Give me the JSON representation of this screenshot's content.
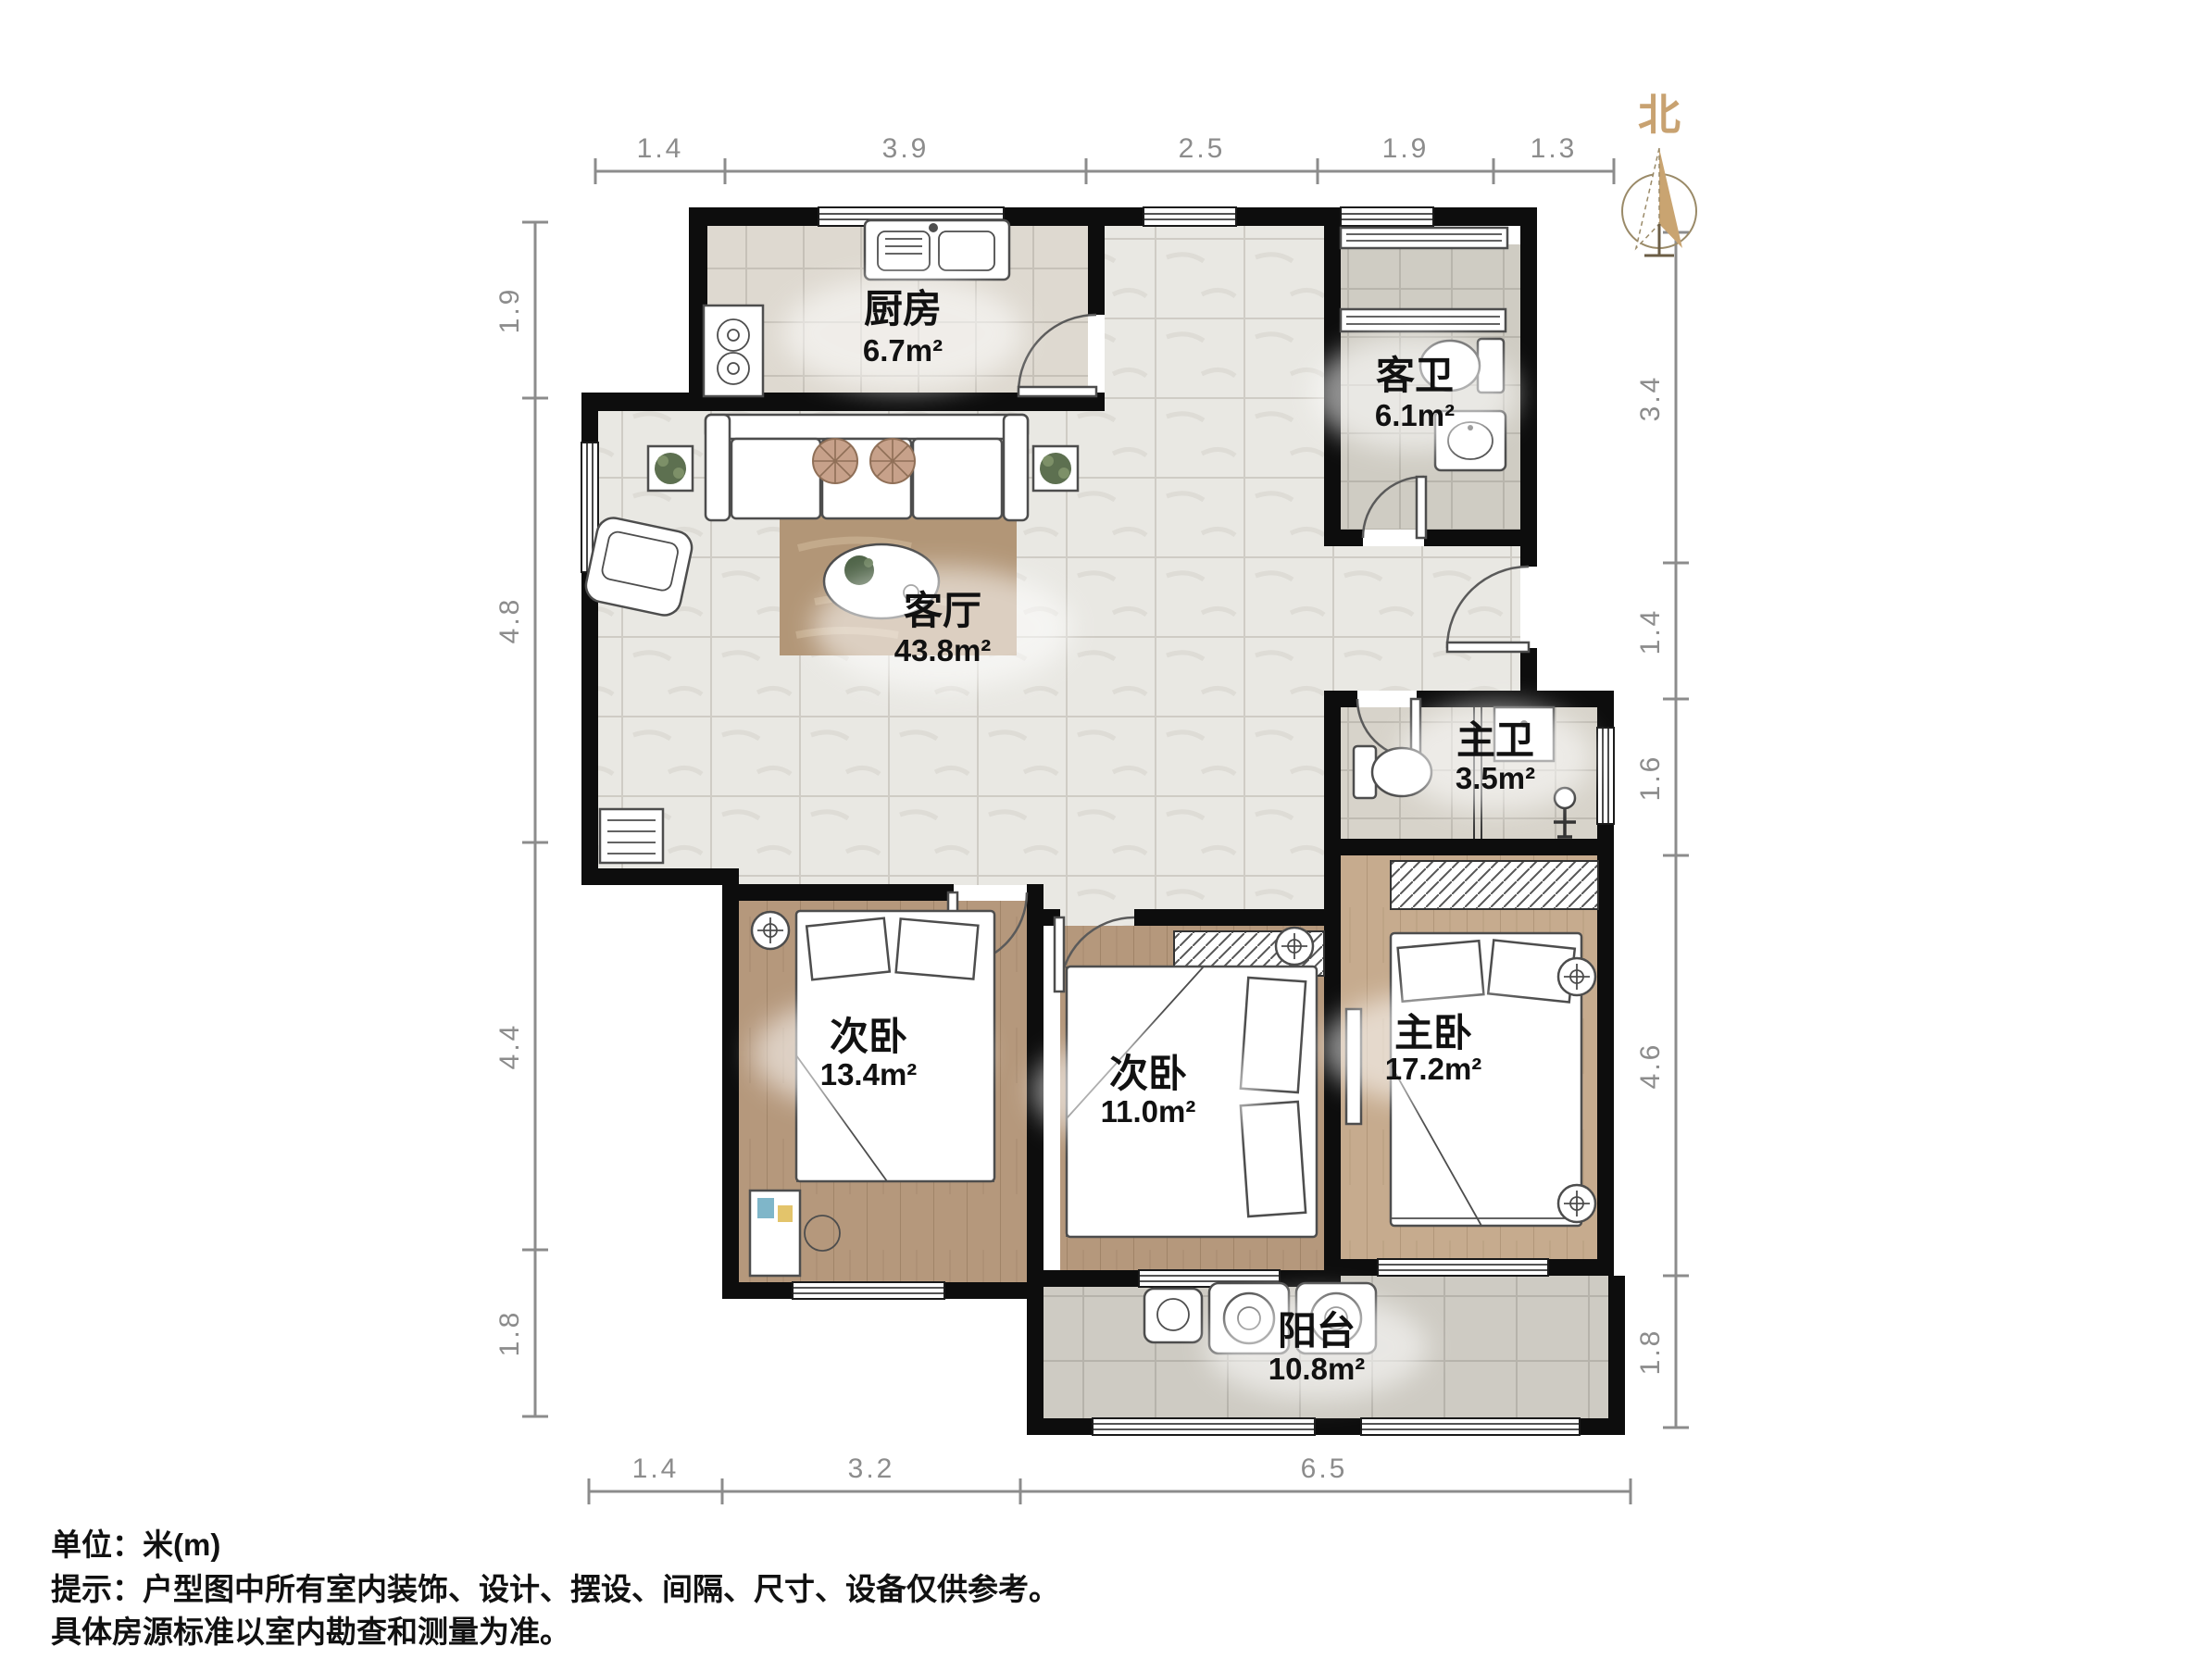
{
  "north": {
    "label": "北"
  },
  "dims": {
    "top": [
      "1.4",
      "3.9",
      "2.5",
      "1.9",
      "1.3"
    ],
    "left": [
      "1.9",
      "4.8",
      "4.4",
      "1.8"
    ],
    "right": [
      "3.4",
      "1.4",
      "1.6",
      "4.6",
      "1.8"
    ],
    "bottom": [
      "1.4",
      "3.2",
      "6.5"
    ]
  },
  "rooms": [
    {
      "name": "厨房",
      "area": "6.7m²"
    },
    {
      "name": "客卫",
      "area": "6.1m²"
    },
    {
      "name": "客厅",
      "area": "43.8m²"
    },
    {
      "name": "主卫",
      "area": "3.5m²"
    },
    {
      "name": "次卧",
      "area": "13.4m²"
    },
    {
      "name": "次卧",
      "area": "11.0m²"
    },
    {
      "name": "主卧",
      "area": "17.2m²"
    },
    {
      "name": "阳台",
      "area": "10.8m²"
    }
  ],
  "footer": {
    "unit": "单位：米(m)",
    "tip": "提示：户型图中所有室内装饰、设计、摆设、间隔、尺寸、设备仅供参考。",
    "tip2": "具体房源标准以室内勘查和测量为准。"
  },
  "colors": {
    "wall": "#0d0d0d",
    "dimension": "#8c8c8c",
    "north_tan": "#c8a271",
    "label_text": "#111111"
  }
}
